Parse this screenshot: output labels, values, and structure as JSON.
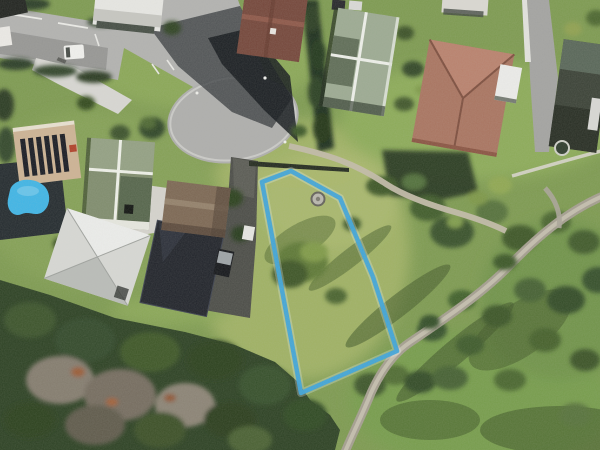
{
  "boundary": {
    "name": "section-boundary-overlay",
    "points": "262,182 291,171 340,198 373,277 397,351 301,393",
    "halo_points": "262,182 291,171 340,198 373,277 397,351 301,393",
    "color": "#3da4da",
    "halo_color": "#e8f4fb",
    "width": "4.5"
  },
  "features": {
    "street": {
      "label": "cul-de-sac street",
      "color": "#b2b2b0"
    },
    "culdesac": {
      "label": "turning circle",
      "color": "#aeaeac"
    },
    "walking_path": {
      "label": "reserve walking path",
      "color": "#a49e8f"
    },
    "upper_path": {
      "label": "path from street to section",
      "color": "#c2bba8"
    },
    "field": {
      "label": "grassy vacant section",
      "color": "#9cb063"
    },
    "forest": {
      "label": "dense tree cover",
      "color": "#2c4123"
    },
    "pool": {
      "label": "swimming pool",
      "color": "#3fb5e6"
    },
    "water_tank": {
      "label": "round tank inside section",
      "color": "#b9b7ae"
    },
    "trampoline": {
      "label": "round trampoline in yard",
      "color": "#2e3b2c"
    },
    "dark_driveway": {
      "label": "asphalt driveway",
      "color": "#4b4c47"
    },
    "concrete_driveway": {
      "label": "concrete driveway",
      "color": "#d8d7d3"
    },
    "houses": [
      {
        "label": "white-roof building top left",
        "color": "#e7e7e3"
      },
      {
        "label": "brown-roof house top",
        "color": "#74463a"
      },
      {
        "label": "sage-green-roof house",
        "color": "#9caa92"
      },
      {
        "label": "terracotta-roof house",
        "color": "#a97460"
      },
      {
        "label": "dark-roof house top right",
        "color": "#3a4136"
      },
      {
        "label": "tan house with solar panels",
        "color": "#cdb394"
      },
      {
        "label": "green-roof house with white ridges",
        "color": "#7f8c6d"
      },
      {
        "label": "white hip-roof house",
        "color": "#d7d8d4"
      },
      {
        "label": "charcoal-roof house",
        "color": "#20232a"
      },
      {
        "label": "taupe-roof house",
        "color": "#7c6753"
      },
      {
        "label": "white outbuilding top centre-right",
        "color": "#dad8d2"
      }
    ],
    "vehicles": [
      {
        "label": "white van on street",
        "color": "#f1f1ee"
      },
      {
        "label": "dark car on driveway",
        "color": "#14161a"
      },
      {
        "label": "parked cars at road end",
        "color": "#26262a"
      }
    ]
  }
}
